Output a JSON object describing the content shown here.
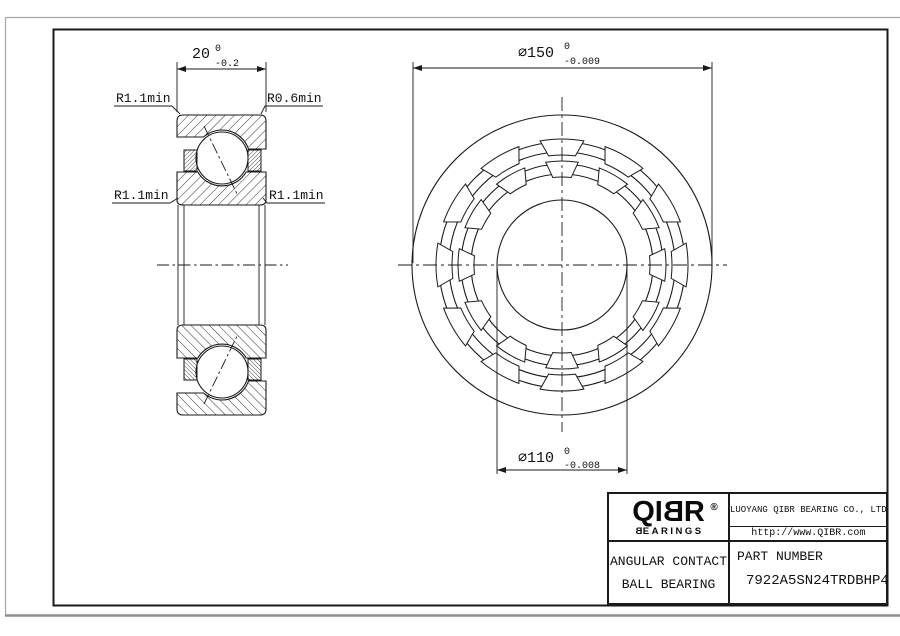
{
  "drawing": {
    "section_view": {
      "width_dim": {
        "value": "20",
        "tol_upper": "0",
        "tol_lower": "-0.2"
      },
      "radius_labels": {
        "top_left": "R1.1min",
        "top_right": "R0.6min",
        "mid_left": "R1.1min",
        "mid_right": "R1.1min"
      }
    },
    "front_view": {
      "outer_diameter_dim": {
        "value": "∅150",
        "tol_upper": "0",
        "tol_lower": "-0.009"
      },
      "bore_diameter_dim": {
        "value": "∅110",
        "tol_upper": "0",
        "tol_lower": "-0.008"
      }
    }
  },
  "title_block": {
    "logo": {
      "part1": "QI",
      "part2": "B",
      "part3": "R",
      "registered": "®",
      "sub_part1": "B",
      "sub_part2": "EARINGS"
    },
    "company_name": "LUOYANG QIBR BEARING CO., LTD",
    "website": "http://www.QIBR.com",
    "product_type_line1": "ANGULAR CONTACT",
    "product_type_line2": "BALL BEARING",
    "part_number_label": "PART NUMBER",
    "part_number": "7922A5SN24TRDBHP4"
  }
}
